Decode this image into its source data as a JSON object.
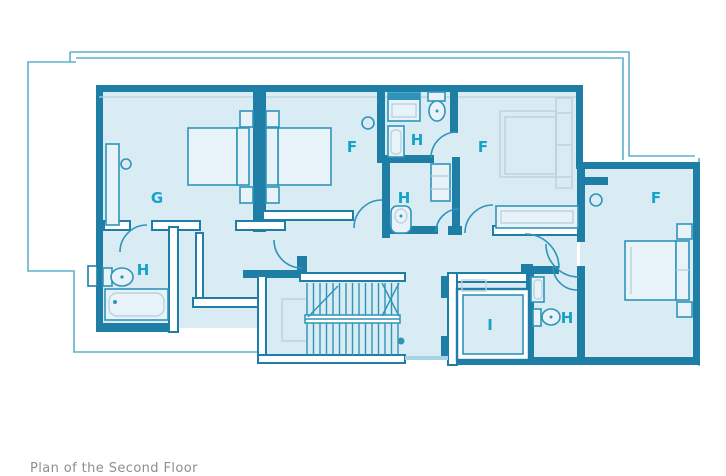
{
  "title": "Floor plan",
  "colors": {
    "background": "#ffffff",
    "floor": "#d9ecf4",
    "wall_dark": "#1e7ea6",
    "wall_medium": "#2f94ba",
    "fixture_fill": "#e8f3f9",
    "light_stroke": "#b9d2de",
    "outline": "#5fb0ce",
    "label": "#16a3c8",
    "caption": "#8e8e8e",
    "threshold": "#a6d3e6"
  },
  "labels": [
    {
      "id": "bedroom-g",
      "text": "G"
    },
    {
      "id": "bedroom-f-left",
      "text": "F"
    },
    {
      "id": "bathroom-top",
      "text": "H"
    },
    {
      "id": "bedroom-f-center",
      "text": "F"
    },
    {
      "id": "bathroom-mid",
      "text": "H"
    },
    {
      "id": "bathroom-left",
      "text": "H"
    },
    {
      "id": "bedroom-f-wing",
      "text": "F"
    },
    {
      "id": "room-i",
      "text": "I"
    },
    {
      "id": "bathroom-right",
      "text": "H"
    }
  ],
  "caption": {
    "text": "Plan of the Second Floor"
  }
}
